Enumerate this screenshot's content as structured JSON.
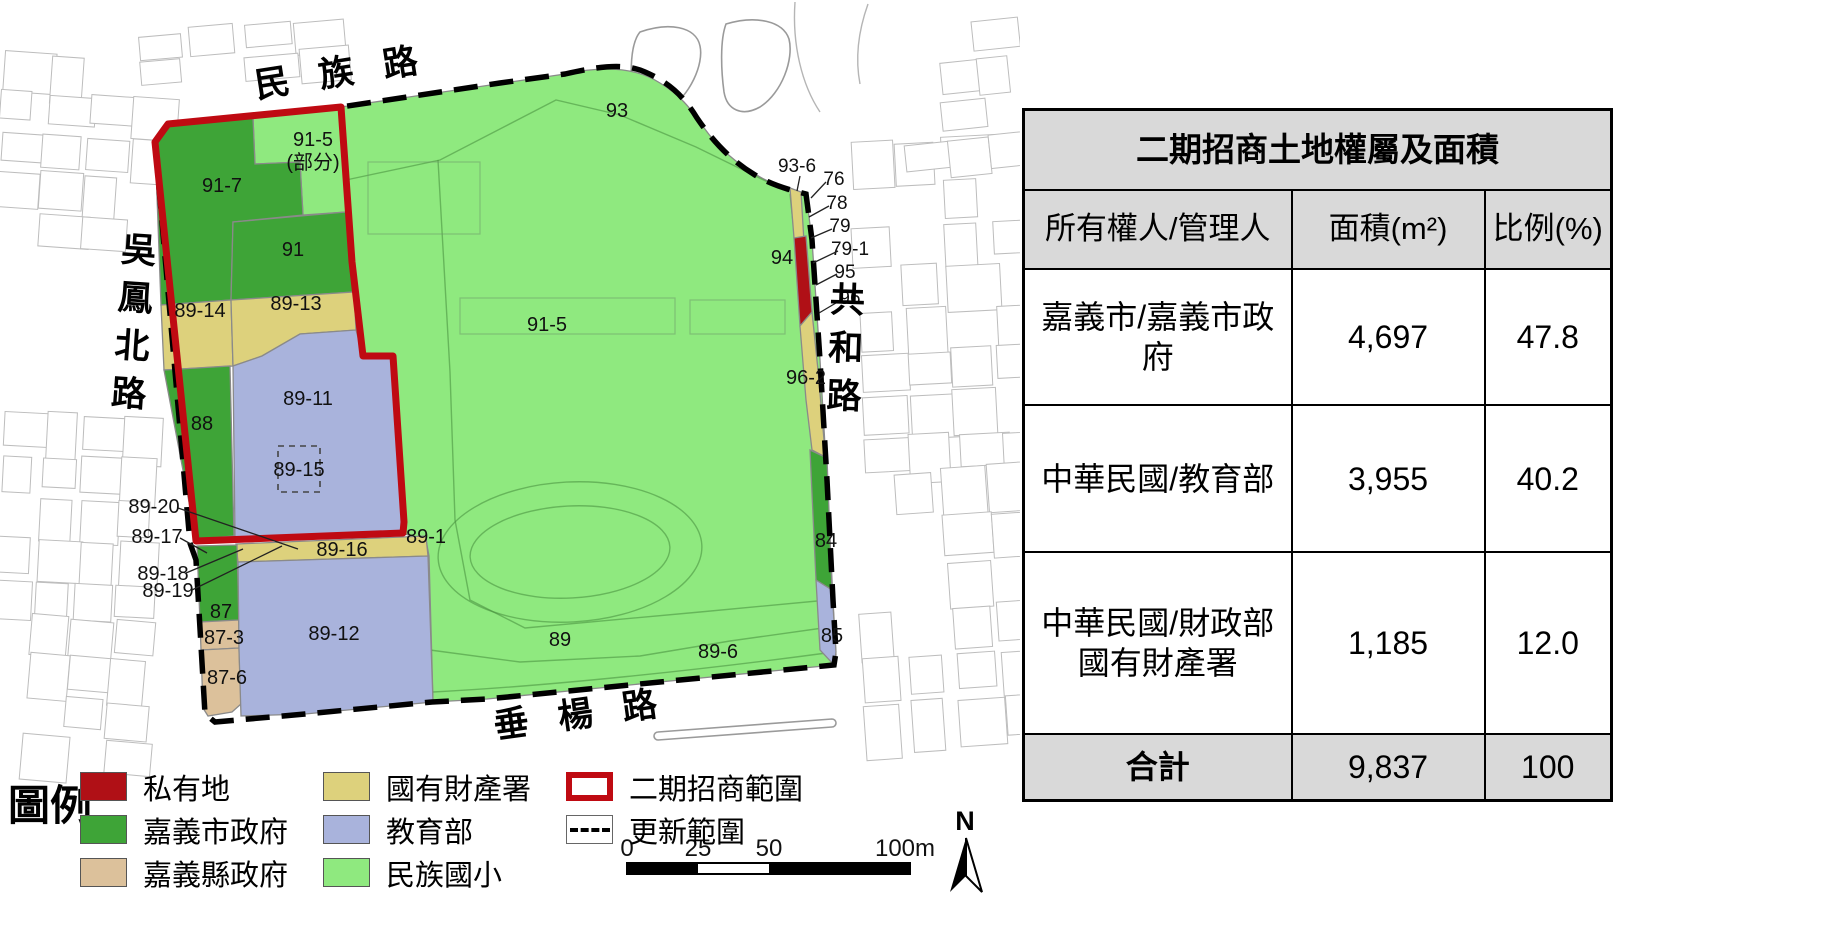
{
  "table": {
    "title": "二期招商土地權屬及面積",
    "columns": [
      "所有權人/管理人",
      "面積(m²)",
      "比例(%)"
    ],
    "rows": [
      {
        "owner": "嘉義市/嘉義市政府",
        "area": "4,697",
        "pct": "47.8"
      },
      {
        "owner": "中華民國/教育部",
        "area": "3,955",
        "pct": "40.2"
      },
      {
        "owner": "中華民國/財政部國有財產署",
        "area": "1,185",
        "pct": "12.0"
      }
    ],
    "total": {
      "label": "合計",
      "area": "9,837",
      "pct": "100"
    }
  },
  "legend": {
    "title": "圖例",
    "items": [
      {
        "col": 0,
        "label": "私有地",
        "swatch": "fill",
        "color": "#b01016"
      },
      {
        "col": 0,
        "label": "嘉義市政府",
        "swatch": "fill",
        "color": "#3ea437"
      },
      {
        "col": 0,
        "label": "嘉義縣政府",
        "swatch": "fill",
        "color": "#dcc19b"
      },
      {
        "col": 1,
        "label": "國有財產署",
        "swatch": "fill",
        "color": "#ddd17c"
      },
      {
        "col": 1,
        "label": "教育部",
        "swatch": "fill",
        "color": "#a9b3dc"
      },
      {
        "col": 1,
        "label": "民族國小",
        "swatch": "fill",
        "color": "#8fe97f"
      },
      {
        "col": 2,
        "label": "二期招商範圍",
        "swatch": "outline",
        "color": "#bf0a12"
      },
      {
        "col": 2,
        "label": "更新範圍",
        "swatch": "dashed",
        "color": "#000000"
      }
    ]
  },
  "map": {
    "roads": [
      {
        "name": "min-zu-road",
        "text": "民 族 路",
        "x": 343,
        "y": 84,
        "rotate": -9
      },
      {
        "name": "wu-feng-north-road",
        "text": "吳鳳北路",
        "x": 138,
        "y": 262,
        "vertical": true,
        "slant": 4
      },
      {
        "name": "chui-yang-road",
        "text": "垂 楊 路",
        "x": 582,
        "y": 726,
        "rotate": -8
      },
      {
        "name": "gong-he-road",
        "text": "共和路",
        "x": 847,
        "y": 312,
        "vertical": true,
        "slant": 2
      }
    ],
    "labels": [
      {
        "text": "91-5",
        "x": 313,
        "y": 146
      },
      {
        "text": "(部分)",
        "x": 313,
        "y": 169
      },
      {
        "text": "91-7",
        "x": 222,
        "y": 192
      },
      {
        "text": "91",
        "x": 293,
        "y": 256
      },
      {
        "text": "89-14",
        "x": 200,
        "y": 317
      },
      {
        "text": "89-13",
        "x": 296,
        "y": 310
      },
      {
        "text": "88",
        "x": 202,
        "y": 430
      },
      {
        "text": "89-11",
        "x": 308,
        "y": 405
      },
      {
        "text": "89-15",
        "x": 299,
        "y": 476
      },
      {
        "text": "89-20",
        "x": 154,
        "y": 513
      },
      {
        "text": "89-17",
        "x": 157,
        "y": 543
      },
      {
        "text": "89-18",
        "x": 163,
        "y": 580
      },
      {
        "text": "89-19",
        "x": 168,
        "y": 597
      },
      {
        "text": "87",
        "x": 221,
        "y": 618
      },
      {
        "text": "87-3",
        "x": 224,
        "y": 644
      },
      {
        "text": "87-6",
        "x": 227,
        "y": 684
      },
      {
        "text": "89-12",
        "x": 334,
        "y": 640
      },
      {
        "text": "89-16",
        "x": 342,
        "y": 556
      },
      {
        "text": "89-1",
        "x": 426,
        "y": 543
      },
      {
        "text": "91-5",
        "x": 547,
        "y": 331
      },
      {
        "text": "93",
        "x": 617,
        "y": 117
      },
      {
        "text": "89",
        "x": 560,
        "y": 646
      },
      {
        "text": "89-6",
        "x": 718,
        "y": 658
      },
      {
        "text": "84",
        "x": 826,
        "y": 547
      },
      {
        "text": "85",
        "x": 832,
        "y": 642
      },
      {
        "text": "94",
        "x": 782,
        "y": 264
      },
      {
        "text": "96-2",
        "x": 806,
        "y": 384
      },
      {
        "text": "93-6",
        "x": 797,
        "y": 172,
        "size": 19
      },
      {
        "text": "76",
        "x": 834,
        "y": 185,
        "size": 19
      },
      {
        "text": "78",
        "x": 837,
        "y": 209,
        "size": 19
      },
      {
        "text": "79",
        "x": 840,
        "y": 232,
        "size": 19
      },
      {
        "text": "79-1",
        "x": 850,
        "y": 255,
        "size": 19
      },
      {
        "text": "95",
        "x": 845,
        "y": 278,
        "size": 19
      },
      {
        "text": "96",
        "x": 850,
        "y": 304,
        "size": 19
      }
    ],
    "leaders": [
      {
        "x1": 178,
        "y1": 508,
        "x2": 298,
        "y2": 549
      },
      {
        "x1": 180,
        "y1": 538,
        "x2": 207,
        "y2": 553
      },
      {
        "x1": 186,
        "y1": 573,
        "x2": 243,
        "y2": 549
      },
      {
        "x1": 192,
        "y1": 590,
        "x2": 282,
        "y2": 546
      },
      {
        "x1": 800,
        "y1": 176,
        "x2": 797,
        "y2": 191
      },
      {
        "x1": 826,
        "y1": 182,
        "x2": 811,
        "y2": 198
      },
      {
        "x1": 829,
        "y1": 206,
        "x2": 809,
        "y2": 217
      },
      {
        "x1": 832,
        "y1": 229,
        "x2": 811,
        "y2": 238
      },
      {
        "x1": 838,
        "y1": 251,
        "x2": 813,
        "y2": 263
      },
      {
        "x1": 837,
        "y1": 274,
        "x2": 816,
        "y2": 285
      },
      {
        "x1": 841,
        "y1": 300,
        "x2": 819,
        "y2": 313
      }
    ],
    "scalebar": {
      "labels": [
        {
          "text": "0",
          "x": 627
        },
        {
          "text": "25",
          "x": 698
        },
        {
          "text": "50",
          "x": 769
        },
        {
          "text": "100m",
          "x": 905
        }
      ],
      "label_y": 856
    },
    "north": "N"
  },
  "colors": {
    "private_red": "#b01016",
    "city_green": "#3ea437",
    "county_tan": "#dcc19b",
    "national_property_khaki": "#ddd17c",
    "moe_lavender": "#a9b3dc",
    "school_light_green": "#8fe97f",
    "phase2_boundary_red": "#bf0a12",
    "table_header_gray": "#d9d9d9"
  }
}
